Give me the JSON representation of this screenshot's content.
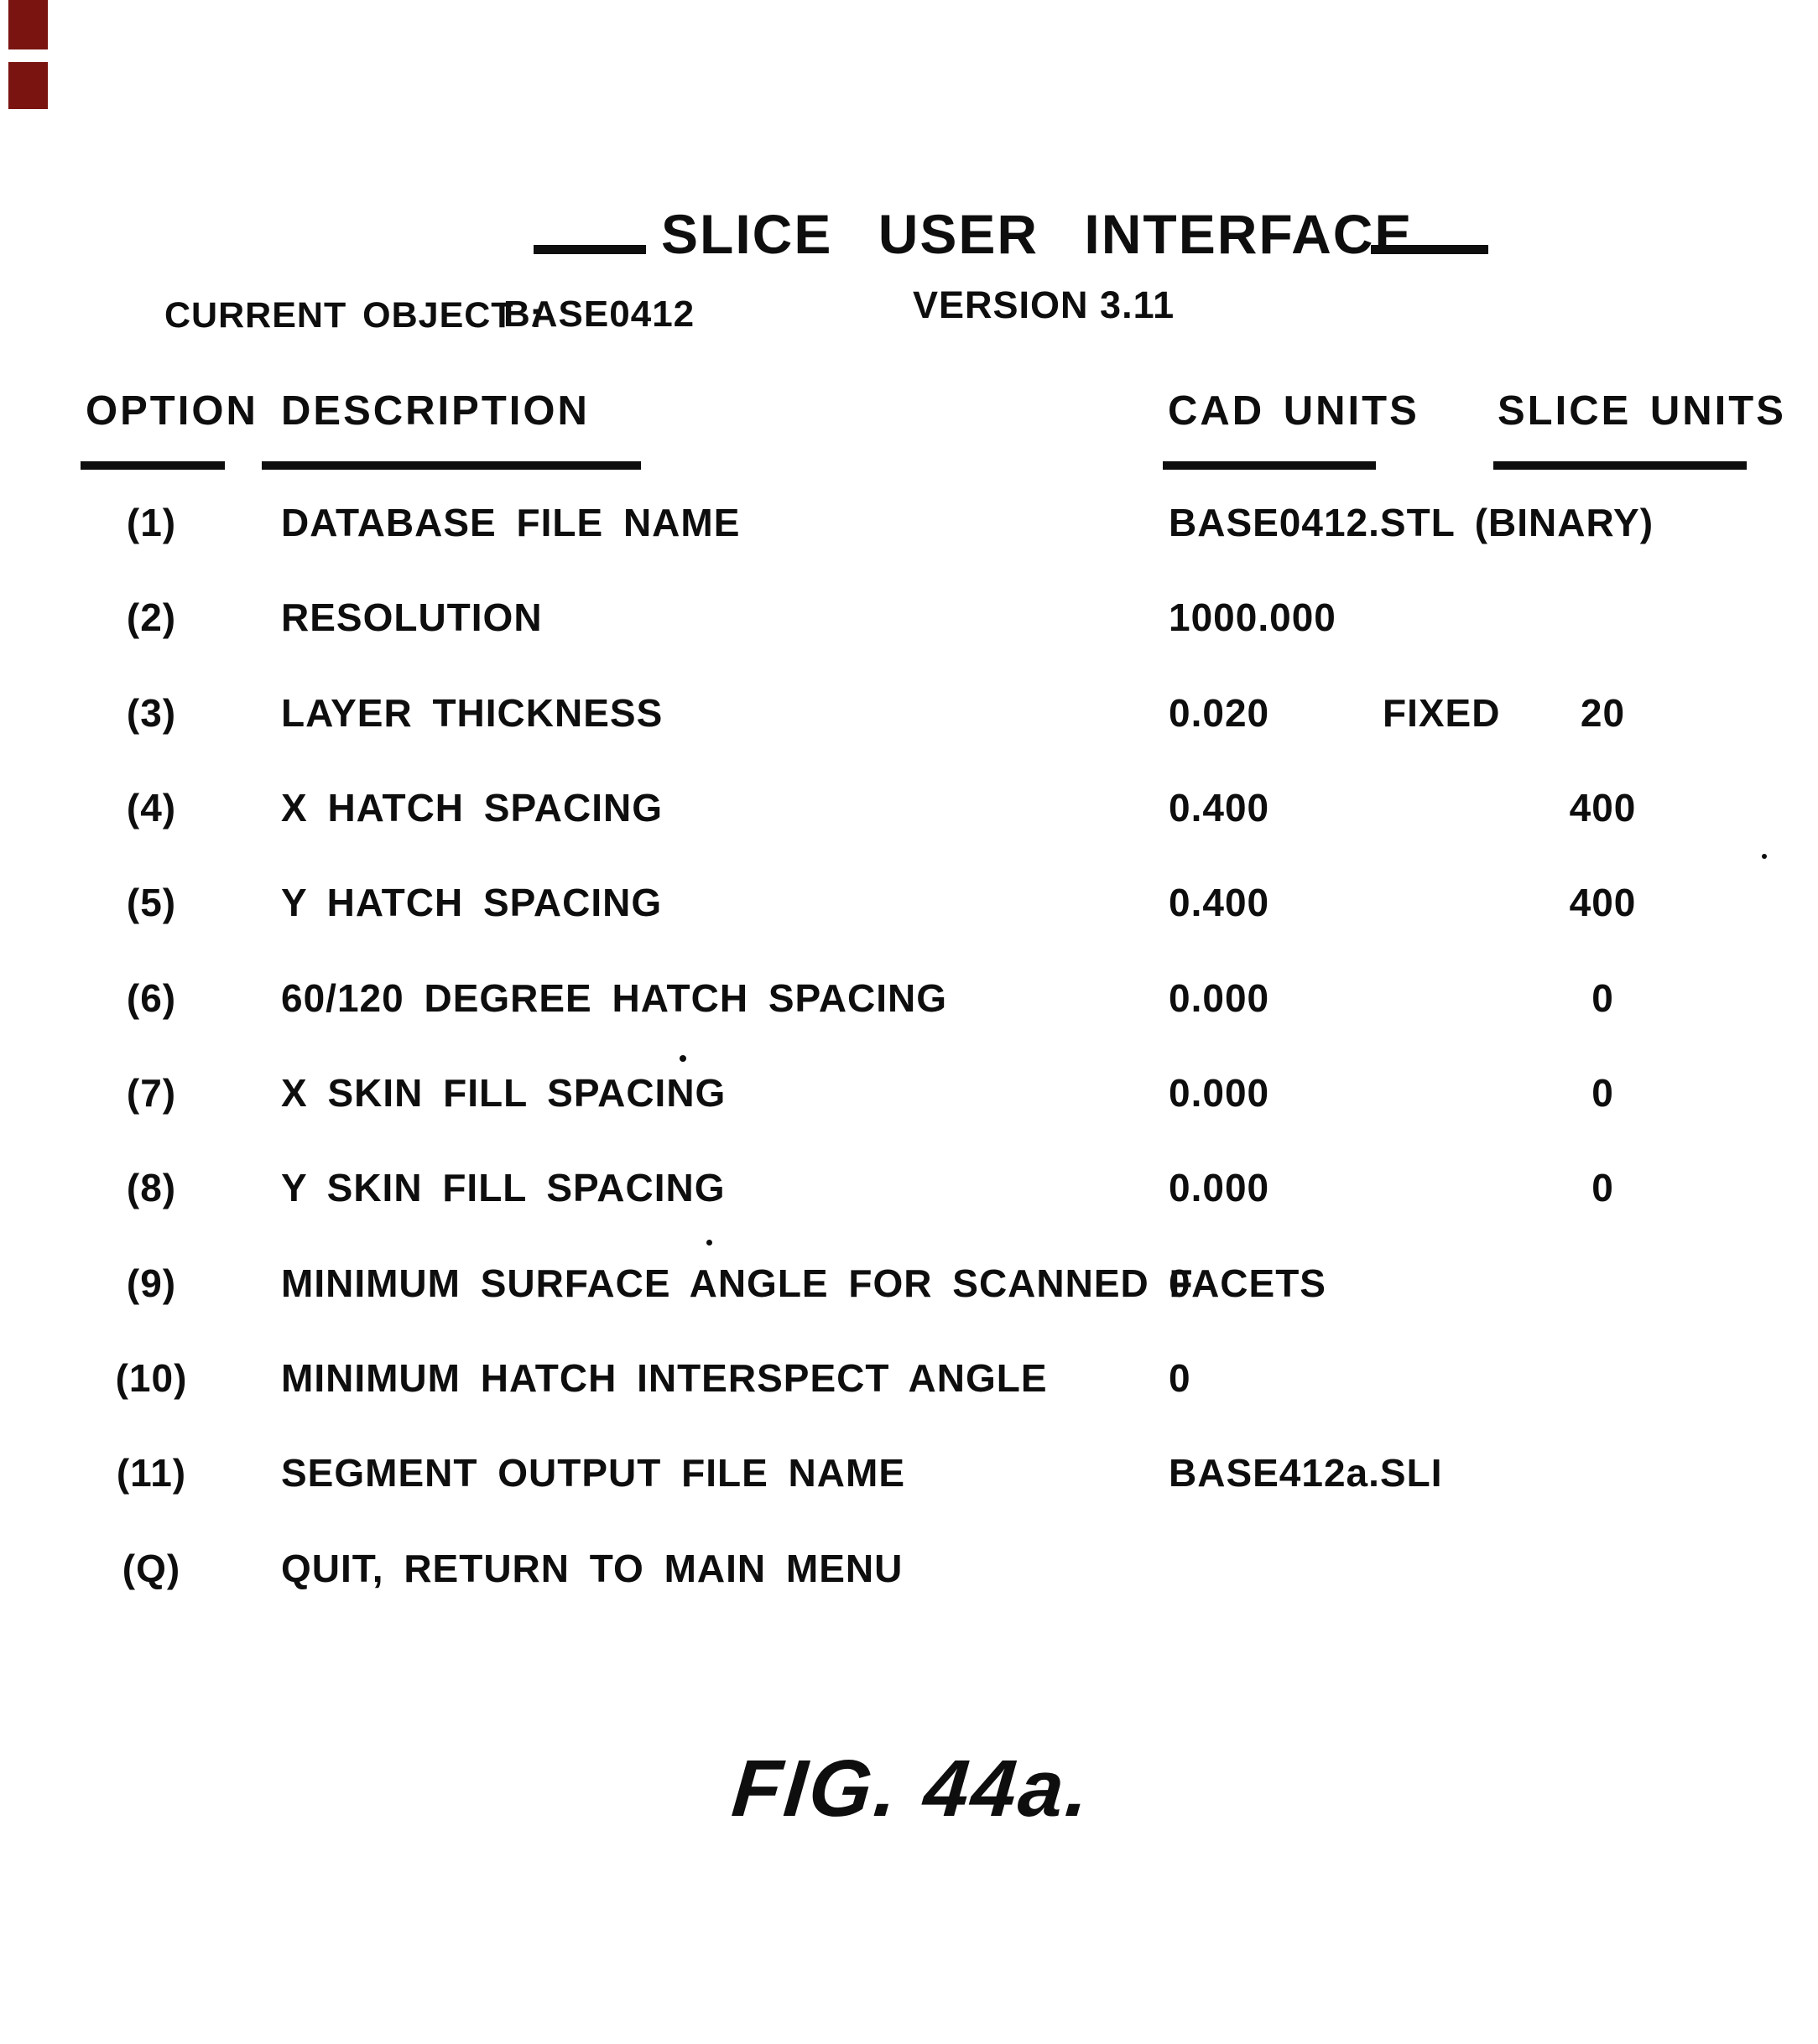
{
  "page": {
    "title": "SLICE USER INTERFACE",
    "version": "VERSION 3.11",
    "current_object_label": "CURRENT OBJECT :",
    "current_object_value": "BASE0412",
    "figure_caption": "FIG. 44a."
  },
  "table": {
    "headers": {
      "option": "OPTION",
      "description": "DESCRIPTION",
      "cad_units": "CAD UNITS",
      "slice_units": "SLICE UNITS"
    },
    "rows": [
      {
        "option": "(1)",
        "description": "DATABASE FILE NAME",
        "cad": "BASE0412.STL (BINARY)",
        "mid": "",
        "slice": ""
      },
      {
        "option": "(2)",
        "description": "RESOLUTION",
        "cad": "1000.000",
        "mid": "",
        "slice": ""
      },
      {
        "option": "(3)",
        "description": "LAYER THICKNESS",
        "cad": "0.020",
        "mid": "FIXED",
        "slice": "20"
      },
      {
        "option": "(4)",
        "description": "X HATCH SPACING",
        "cad": "0.400",
        "mid": "",
        "slice": "400"
      },
      {
        "option": "(5)",
        "description": "Y HATCH SPACING",
        "cad": "0.400",
        "mid": "",
        "slice": "400"
      },
      {
        "option": "(6)",
        "description": "60/120 DEGREE HATCH SPACING",
        "cad": "0.000",
        "mid": "",
        "slice": "0"
      },
      {
        "option": "(7)",
        "description": "X SKIN FILL SPACING",
        "cad": "0.000",
        "mid": "",
        "slice": "0"
      },
      {
        "option": "(8)",
        "description": "Y SKIN FILL SPACING",
        "cad": "0.000",
        "mid": "",
        "slice": "0"
      },
      {
        "option": "(9)",
        "description": "MINIMUM SURFACE ANGLE FOR SCANNED FACETS",
        "cad": "0",
        "mid": "",
        "slice": ""
      },
      {
        "option": "(10)",
        "description": "MINIMUM HATCH INTERSPECT ANGLE",
        "cad": "0",
        "mid": "",
        "slice": ""
      },
      {
        "option": "(11)",
        "description": "SEGMENT OUTPUT FILE NAME",
        "cad": "BASE412a.SLI",
        "mid": "",
        "slice": ""
      },
      {
        "option": "(Q)",
        "description": "QUIT, RETURN TO MAIN MENU",
        "cad": "",
        "mid": "",
        "slice": ""
      }
    ]
  },
  "colors": {
    "ink": "#0e0e0e",
    "paper": "#ffffff",
    "edge_mark": "#7a1410"
  }
}
